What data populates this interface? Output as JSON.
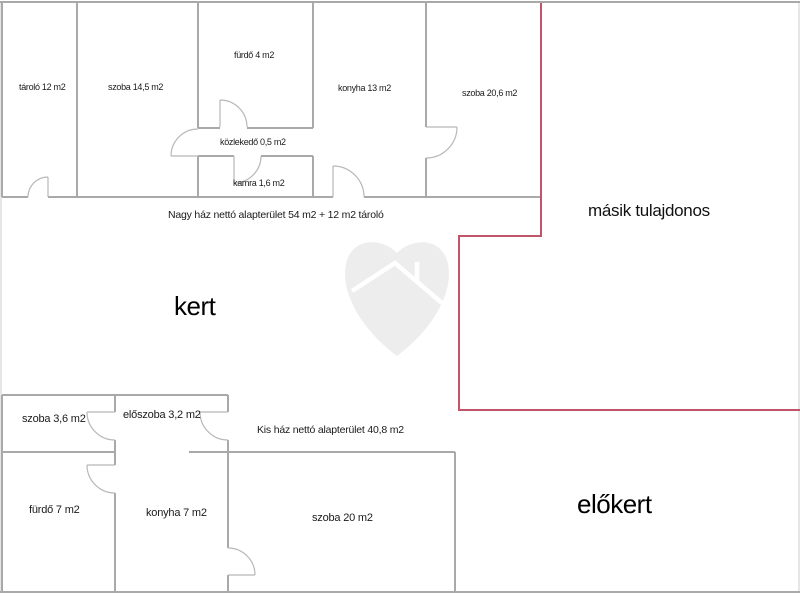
{
  "plan": {
    "big_house": {
      "summary": "Nagy ház nettó alapterület 54 m2 + 12 m2 tároló",
      "rooms": {
        "tarolo": "tároló 12 m2",
        "szoba_14_5": "szoba 14,5 m2",
        "furdo": "fürdő 4 m2",
        "konyha": "konyha 13 m2",
        "szoba_20_6": "szoba 20,6 m2",
        "kozlekedo": "közlekedő 0,5 m2",
        "kamra": "kamra 1,6 m2"
      }
    },
    "small_house": {
      "summary": "Kis ház nettó alapterület 40,8 m2",
      "rooms": {
        "szoba_3_6": "szoba 3,6 m2",
        "eloszoba": "előszoba 3,2 m2",
        "furdo": "fürdő 7 m2",
        "konyha": "konyha 7 m2",
        "szoba_20": "szoba 20 m2"
      }
    },
    "outdoor": {
      "garden": "kert",
      "front_garden": "előkert",
      "other_owner": "másik tulajdonos"
    },
    "colors": {
      "wall": "#a9a9a9",
      "edge": "#cccccc",
      "door": "#b8b8b8",
      "boundary": "#c05468",
      "watermark": "#ededed",
      "roof": "#ffffff"
    }
  }
}
